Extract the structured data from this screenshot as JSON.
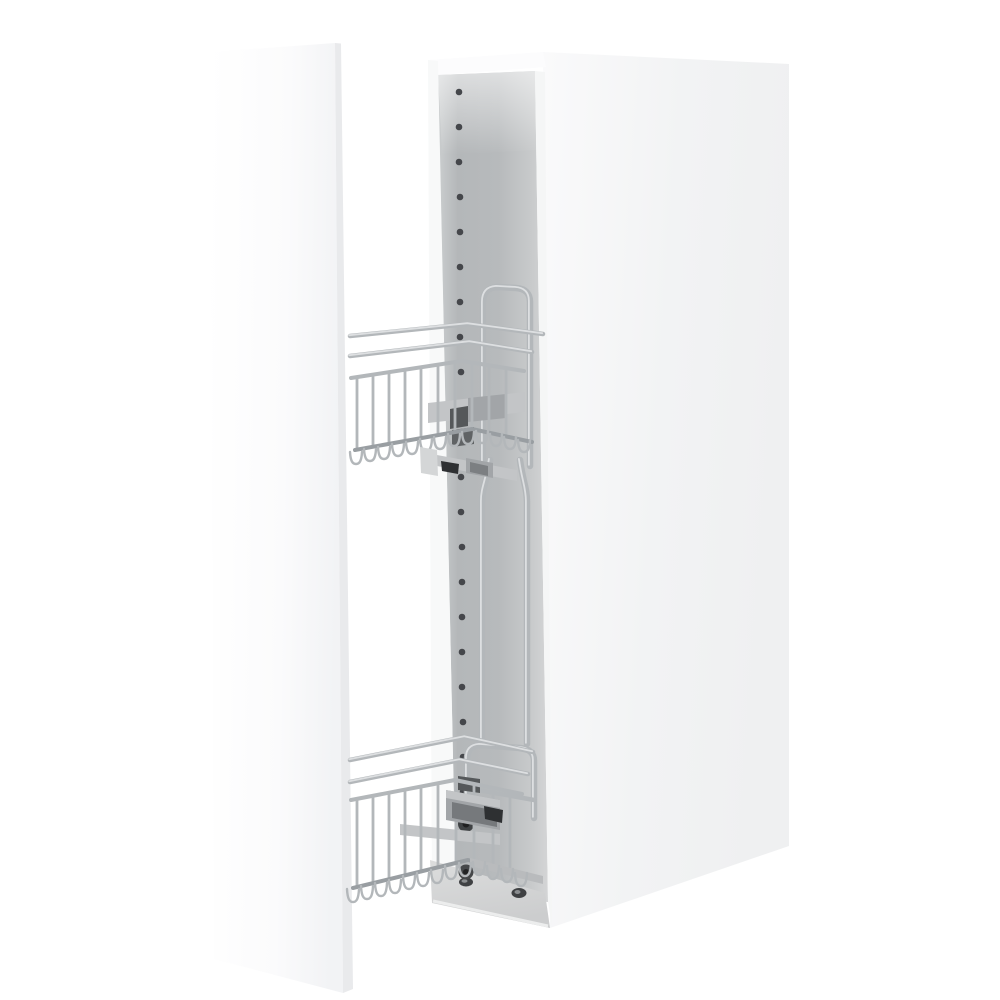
{
  "title": {
    "text": "Варианты сборки:"
  },
  "colors": {
    "background": "#ffffff",
    "title_color": "#3d4451",
    "door_face": "#ffffff",
    "panel_face": "#f2f3f4",
    "panel_face_light": "#fafafb",
    "panel_edge": "#e9eaec",
    "interior_light": "#cbcecf",
    "interior_mid": "#b4b7b9",
    "interior_lighter": "#d4d5d6",
    "underside": "#d6d7d8",
    "chrome_main": "#b3b7ba",
    "chrome_highlight": "#e4e6e8",
    "chrome_dark": "#999ea2",
    "mech_gray": "#c3c5c7",
    "mech_mid": "#a2a5a8",
    "mech_dark": "#55585a",
    "hardware_black": "#2e3032",
    "hole_dot": "#45474b",
    "screw_dark": "#3f4143"
  },
  "scene": {
    "parts": {
      "door": "door-panel",
      "cabinet": "cabinet-carcass",
      "upper_basket": "upper-wire-basket",
      "lower_basket": "lower-wire-basket"
    },
    "shelf_pin_hole_rows": 21
  }
}
